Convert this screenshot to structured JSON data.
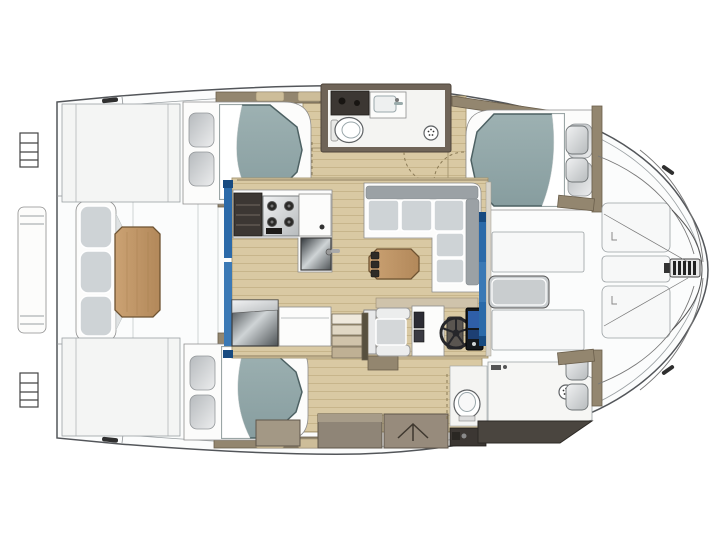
{
  "figure": {
    "kind": "catamaran-interior-floor-plan",
    "view": "overhead",
    "canvas": {
      "width": 720,
      "height": 540
    }
  },
  "palette": {
    "bg": "#ffffff",
    "hull-outline": "#53565a",
    "deck-white": "#fbfcfc",
    "deck-line": "#9aa0a3",
    "wood-floor": "#d9c9a3",
    "wood-grain": "#c3b084",
    "wall-taupe": "#93866f",
    "wall-taupe-dark": "#6b5f4c",
    "table-light": "#cba273",
    "table-dark": "#b2885a",
    "table-border": "#6e5332",
    "mattress-light": "#9db1b2",
    "mattress-dark": "#879d9f",
    "mattress-edge": "#4d6163",
    "pillow-light": "#ecedee",
    "pillow-dark": "#b6babd",
    "cushion-gray": "#ced3d6",
    "cushion-back-gray": "#9ba1a5",
    "dark-counter": "#3c3733",
    "near-black": "#201d19",
    "metal-light": "#f1f2f3",
    "metal-dark": "#b7bbbd",
    "mirror-a": "#31363a",
    "mirror-b": "#cfd4d6",
    "mirror-c": "#4e5356",
    "glass-blue": "#2b6aa9",
    "glass-blue-light": "#3b79b5",
    "glass-blue-dark": "#174a80",
    "screen-blue": "#2f5fa8",
    "screen-blue-dim": "#1d3f73"
  },
  "fixtures": [
    "double-berth",
    "pillow",
    "mattress-sheet-fold",
    "shower-head-icon",
    "toilet",
    "sink-basin",
    "faucet",
    "stove-burners",
    "galley-sink",
    "refrigerator-mirror-front",
    "helm-wheel",
    "chart-plotter-screens",
    "helm-seat",
    "l-shaped-sofa",
    "coffee-table",
    "cockpit-bench",
    "cockpit-table",
    "wardrobe-hanger-icon",
    "deck-hatch",
    "foredeck-locker",
    "bow-windlass",
    "boarding-ladder",
    "cleat",
    "genoa-track",
    "sliding-glass-door",
    "companionway-stairs",
    "door-swing-dashed",
    "aft-platform",
    "trampoline-lines"
  ]
}
